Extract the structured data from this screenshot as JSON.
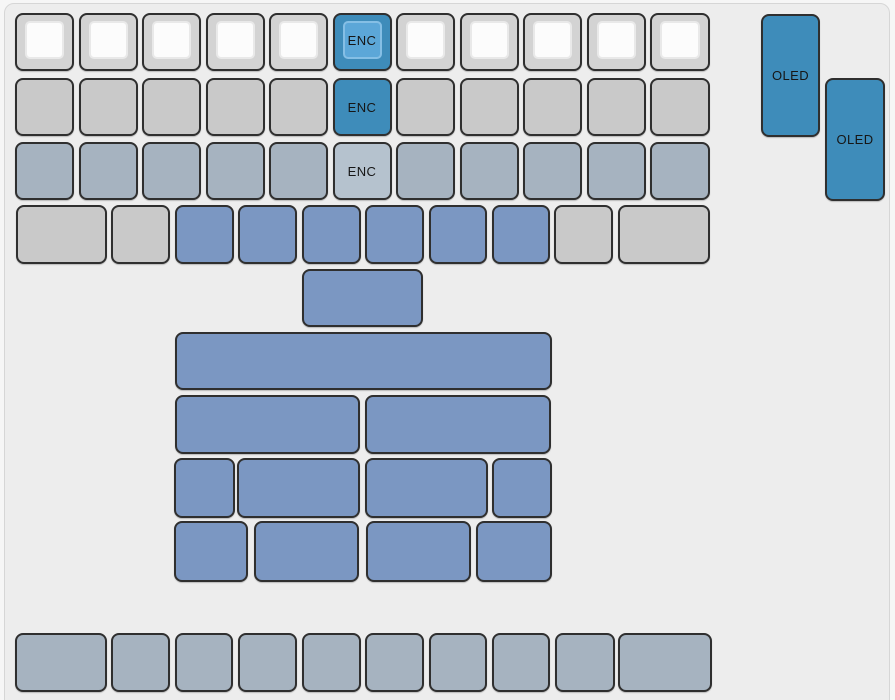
{
  "window": {
    "width_px": 895,
    "height_px": 700,
    "background": "#f6f6f6"
  },
  "panel": {
    "background": "#ededed",
    "border_color": "#d6d6d6"
  },
  "labels": {
    "encoder": "ENC",
    "oled": "OLED"
  },
  "key_styles": {
    "capWhite": {
      "body": "#d3d3d3",
      "top": "#fcfcfc",
      "topBorder": "#e9e9e9"
    },
    "capBlue": {
      "body": "#3e8cba",
      "top": "#5ca7d8",
      "topBorder": "#85bfe5"
    },
    "gray": {
      "body": "#c9c9c9"
    },
    "blueGray": {
      "body": "#a6b3c0"
    },
    "blueGrayLight": {
      "body": "#b5c2ce"
    },
    "blue": {
      "body": "#7b97c2"
    },
    "blueDark": {
      "body": "#3e8cba"
    }
  },
  "keyboard": {
    "key_border_color": "#2f2f2f",
    "text_color": "#161616",
    "keys": [
      {
        "x": 15,
        "y": 13,
        "w": 59,
        "h": 58,
        "s": "capWhite"
      },
      {
        "x": 78.5,
        "y": 13,
        "w": 59,
        "h": 58,
        "s": "capWhite"
      },
      {
        "x": 142,
        "y": 13,
        "w": 59,
        "h": 58,
        "s": "capWhite"
      },
      {
        "x": 205.5,
        "y": 13,
        "w": 59,
        "h": 58,
        "s": "capWhite"
      },
      {
        "x": 269,
        "y": 13,
        "w": 59,
        "h": 58,
        "s": "capWhite"
      },
      {
        "x": 332.5,
        "y": 13,
        "w": 59,
        "h": 58,
        "s": "capBlue",
        "label": "ENC"
      },
      {
        "x": 396,
        "y": 13,
        "w": 59,
        "h": 58,
        "s": "capWhite"
      },
      {
        "x": 459.5,
        "y": 13,
        "w": 59,
        "h": 58,
        "s": "capWhite"
      },
      {
        "x": 523,
        "y": 13,
        "w": 59,
        "h": 58,
        "s": "capWhite"
      },
      {
        "x": 586.5,
        "y": 13,
        "w": 59,
        "h": 58,
        "s": "capWhite"
      },
      {
        "x": 650,
        "y": 13,
        "w": 60,
        "h": 58,
        "s": "capWhite"
      },
      {
        "x": 15,
        "y": 78,
        "w": 59,
        "h": 58,
        "s": "gray"
      },
      {
        "x": 78.5,
        "y": 78,
        "w": 59,
        "h": 58,
        "s": "gray"
      },
      {
        "x": 142,
        "y": 78,
        "w": 59,
        "h": 58,
        "s": "gray"
      },
      {
        "x": 205.5,
        "y": 78,
        "w": 59,
        "h": 58,
        "s": "gray"
      },
      {
        "x": 269,
        "y": 78,
        "w": 59,
        "h": 58,
        "s": "gray"
      },
      {
        "x": 332.5,
        "y": 78,
        "w": 59,
        "h": 58,
        "s": "blueDark",
        "label": "ENC"
      },
      {
        "x": 396,
        "y": 78,
        "w": 59,
        "h": 58,
        "s": "gray"
      },
      {
        "x": 459.5,
        "y": 78,
        "w": 59,
        "h": 58,
        "s": "gray"
      },
      {
        "x": 523,
        "y": 78,
        "w": 59,
        "h": 58,
        "s": "gray"
      },
      {
        "x": 586.5,
        "y": 78,
        "w": 59,
        "h": 58,
        "s": "gray"
      },
      {
        "x": 650,
        "y": 78,
        "w": 60,
        "h": 58,
        "s": "gray"
      },
      {
        "x": 15,
        "y": 142,
        "w": 59,
        "h": 58,
        "s": "blueGray"
      },
      {
        "x": 78.5,
        "y": 142,
        "w": 59,
        "h": 58,
        "s": "blueGray"
      },
      {
        "x": 142,
        "y": 142,
        "w": 59,
        "h": 58,
        "s": "blueGray"
      },
      {
        "x": 205.5,
        "y": 142,
        "w": 59,
        "h": 58,
        "s": "blueGray"
      },
      {
        "x": 269,
        "y": 142,
        "w": 59,
        "h": 58,
        "s": "blueGray"
      },
      {
        "x": 332.5,
        "y": 142,
        "w": 59,
        "h": 58,
        "s": "blueGrayLight",
        "label": "ENC"
      },
      {
        "x": 396,
        "y": 142,
        "w": 59,
        "h": 58,
        "s": "blueGray"
      },
      {
        "x": 459.5,
        "y": 142,
        "w": 59,
        "h": 58,
        "s": "blueGray"
      },
      {
        "x": 523,
        "y": 142,
        "w": 59,
        "h": 58,
        "s": "blueGray"
      },
      {
        "x": 586.5,
        "y": 142,
        "w": 59,
        "h": 58,
        "s": "blueGray"
      },
      {
        "x": 650,
        "y": 142,
        "w": 60,
        "h": 58,
        "s": "blueGray"
      },
      {
        "x": 15.5,
        "y": 205,
        "w": 91,
        "h": 59,
        "s": "gray"
      },
      {
        "x": 111,
        "y": 205,
        "w": 59,
        "h": 59,
        "s": "gray"
      },
      {
        "x": 174.5,
        "y": 205,
        "w": 59,
        "h": 59,
        "s": "blue"
      },
      {
        "x": 238,
        "y": 205,
        "w": 59,
        "h": 59,
        "s": "blue"
      },
      {
        "x": 301.5,
        "y": 205,
        "w": 59,
        "h": 59,
        "s": "blue"
      },
      {
        "x": 365,
        "y": 205,
        "w": 59,
        "h": 59,
        "s": "blue"
      },
      {
        "x": 428.5,
        "y": 205,
        "w": 58,
        "h": 59,
        "s": "blue"
      },
      {
        "x": 492,
        "y": 205,
        "w": 58,
        "h": 59,
        "s": "blue"
      },
      {
        "x": 554,
        "y": 205,
        "w": 59,
        "h": 59,
        "s": "gray"
      },
      {
        "x": 618,
        "y": 205,
        "w": 92,
        "h": 59,
        "s": "gray"
      },
      {
        "x": 302,
        "y": 269,
        "w": 121,
        "h": 58,
        "s": "blue"
      },
      {
        "x": 175,
        "y": 332,
        "w": 377,
        "h": 58,
        "s": "blue"
      },
      {
        "x": 174.5,
        "y": 395,
        "w": 185.5,
        "h": 59,
        "s": "blue"
      },
      {
        "x": 365,
        "y": 395,
        "w": 185.5,
        "h": 59,
        "s": "blue"
      },
      {
        "x": 173.5,
        "y": 458,
        "w": 61,
        "h": 60,
        "s": "blue"
      },
      {
        "x": 237,
        "y": 458,
        "w": 122.5,
        "h": 60,
        "s": "blue"
      },
      {
        "x": 365,
        "y": 458,
        "w": 122.5,
        "h": 60,
        "s": "blue"
      },
      {
        "x": 491.5,
        "y": 458,
        "w": 60,
        "h": 60,
        "s": "blue"
      },
      {
        "x": 173.5,
        "y": 521,
        "w": 74,
        "h": 61,
        "s": "blue"
      },
      {
        "x": 254,
        "y": 521,
        "w": 105,
        "h": 61,
        "s": "blue"
      },
      {
        "x": 365.5,
        "y": 521,
        "w": 105,
        "h": 61,
        "s": "blue"
      },
      {
        "x": 476,
        "y": 521,
        "w": 76,
        "h": 61,
        "s": "blue"
      },
      {
        "x": 15,
        "y": 633,
        "w": 92,
        "h": 59,
        "s": "blueGray"
      },
      {
        "x": 111,
        "y": 633,
        "w": 59,
        "h": 59,
        "s": "blueGray"
      },
      {
        "x": 174.5,
        "y": 633,
        "w": 58,
        "h": 59,
        "s": "blueGray"
      },
      {
        "x": 238,
        "y": 633,
        "w": 59,
        "h": 59,
        "s": "blueGray"
      },
      {
        "x": 301.5,
        "y": 633,
        "w": 59,
        "h": 59,
        "s": "blueGray"
      },
      {
        "x": 365,
        "y": 633,
        "w": 59,
        "h": 59,
        "s": "blueGray"
      },
      {
        "x": 428.5,
        "y": 633,
        "w": 58,
        "h": 59,
        "s": "blueGray"
      },
      {
        "x": 491.5,
        "y": 633,
        "w": 58.5,
        "h": 59,
        "s": "blueGray"
      },
      {
        "x": 554.5,
        "y": 633,
        "w": 60.5,
        "h": 59,
        "s": "blueGray"
      },
      {
        "x": 618,
        "y": 633,
        "w": 94,
        "h": 59,
        "s": "blueGray"
      },
      {
        "x": 761,
        "y": 14,
        "w": 59,
        "h": 123,
        "s": "blueDark",
        "label": "OLED"
      },
      {
        "x": 825,
        "y": 78,
        "w": 60,
        "h": 123,
        "s": "blueDark",
        "label": "OLED"
      }
    ]
  }
}
